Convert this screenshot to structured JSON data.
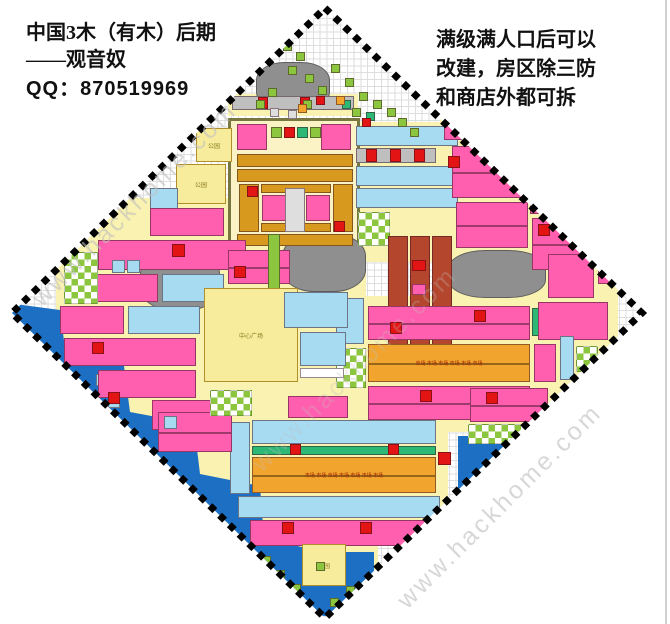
{
  "header": {
    "left": {
      "line1": "中国3木（有木）后期",
      "line2": "——观音奴",
      "line3": "QQ：870519969"
    },
    "right": {
      "line1": "满级满人口后可以",
      "line2": "改建，房区除三防",
      "line3": "和商店外都可拆"
    }
  },
  "watermark": {
    "text": "www.hackhome.com"
  },
  "map": {
    "labels": {
      "plaza": "中心广场",
      "park": "公园",
      "market": "市场"
    },
    "colors": {
      "road": "#FAF2B0",
      "cream": "#FBF3C6",
      "P": "#FF5FAE",
      "R": "#E21414",
      "C": "#A6DBF2",
      "B": "#1C6FC2",
      "G": "#8CC63F",
      "T": "#2EB876",
      "O": "#F2A52E",
      "D": "#D79A1E",
      "M": "#B5462E",
      "A": "#8F8F8F",
      "E": "#DEDEDE",
      "N": "#BFBFBF",
      "L": "#F7EC9C",
      "W": "#FFFFFF"
    },
    "rects": [
      {
        "x": 228,
        "y": 94,
        "w": 130,
        "h": 22,
        "c": "road"
      },
      {
        "x": 352,
        "y": 122,
        "w": 112,
        "h": 140,
        "c": "road"
      },
      {
        "x": 440,
        "y": 84,
        "w": 140,
        "h": 100,
        "c": "road"
      },
      {
        "x": 448,
        "y": 180,
        "w": 170,
        "h": 250,
        "c": "road"
      },
      {
        "x": 56,
        "y": 198,
        "w": 176,
        "h": 242,
        "c": "road"
      },
      {
        "x": 198,
        "y": 238,
        "w": 168,
        "h": 154,
        "c": "road"
      },
      {
        "x": 148,
        "y": 390,
        "w": 234,
        "h": 150,
        "c": "road"
      },
      {
        "x": 234,
        "y": 414,
        "w": 214,
        "h": 128,
        "c": "road"
      },
      {
        "x": 278,
        "y": 538,
        "w": 100,
        "h": 58,
        "c": "road"
      },
      {
        "x": 350,
        "y": 296,
        "w": 186,
        "h": 136,
        "c": "road"
      },
      {
        "x": 228,
        "y": 118,
        "w": 132,
        "h": 128,
        "c": "cream",
        "bd": "cream"
      },
      {
        "poly": "0,302 60,310 66,356 124,366 130,412 194,424 200,474 260,486 264,538 314,550 320,624 0,624",
        "c": "B",
        "g": "b"
      },
      {
        "x": 458,
        "y": 436,
        "w": 90,
        "h": 86,
        "c": "B",
        "g": "b"
      },
      {
        "x": 298,
        "y": 552,
        "w": 76,
        "h": 64,
        "c": "B",
        "g": "b"
      },
      {
        "x": 222,
        "y": 540,
        "w": 66,
        "h": 58,
        "c": "B",
        "g": "b"
      },
      {
        "x": 84,
        "y": 350,
        "w": 12,
        "h": 12,
        "c": "C"
      },
      {
        "x": 96,
        "y": 374,
        "w": 12,
        "h": 12,
        "c": "C"
      },
      {
        "x": 108,
        "y": 396,
        "w": 12,
        "h": 12,
        "c": "C"
      },
      {
        "x": 256,
        "y": 62,
        "w": 74,
        "h": 48,
        "c": "A",
        "g": "a",
        "r": 38
      },
      {
        "x": 140,
        "y": 252,
        "w": 80,
        "h": 58,
        "c": "A",
        "g": "a",
        "r": 38
      },
      {
        "x": 282,
        "y": 234,
        "w": 84,
        "h": 58,
        "c": "A",
        "g": "a",
        "r": 38
      },
      {
        "x": 448,
        "y": 250,
        "w": 98,
        "h": 48,
        "c": "A",
        "g": "a",
        "r": 38
      },
      {
        "x": 237,
        "y": 124,
        "w": 30,
        "h": 26,
        "c": "P"
      },
      {
        "x": 321,
        "y": 124,
        "w": 30,
        "h": 26,
        "c": "P"
      },
      {
        "x": 271,
        "y": 127,
        "w": 11,
        "h": 11,
        "c": "G"
      },
      {
        "x": 284,
        "y": 127,
        "w": 11,
        "h": 11,
        "c": "R"
      },
      {
        "x": 297,
        "y": 127,
        "w": 11,
        "h": 11,
        "c": "T"
      },
      {
        "x": 310,
        "y": 127,
        "w": 11,
        "h": 11,
        "c": "G"
      },
      {
        "x": 237,
        "y": 154,
        "w": 116,
        "h": 13,
        "c": "D",
        "u": 11
      },
      {
        "x": 237,
        "y": 169,
        "w": 116,
        "h": 13,
        "c": "D",
        "u": 11
      },
      {
        "x": 239,
        "y": 184,
        "w": 20,
        "h": 48,
        "c": "D"
      },
      {
        "x": 333,
        "y": 184,
        "w": 20,
        "h": 48,
        "c": "D"
      },
      {
        "x": 261,
        "y": 184,
        "w": 70,
        "h": 9,
        "c": "D"
      },
      {
        "x": 261,
        "y": 223,
        "w": 70,
        "h": 9,
        "c": "D"
      },
      {
        "x": 262,
        "y": 195,
        "w": 24,
        "h": 26,
        "c": "P"
      },
      {
        "x": 306,
        "y": 195,
        "w": 24,
        "h": 26,
        "c": "P"
      },
      {
        "x": 285,
        "y": 188,
        "w": 20,
        "h": 44,
        "c": "E"
      },
      {
        "x": 247,
        "y": 186,
        "w": 11,
        "h": 11,
        "c": "R"
      },
      {
        "x": 334,
        "y": 221,
        "w": 11,
        "h": 11,
        "c": "R"
      },
      {
        "x": 237,
        "y": 234,
        "w": 116,
        "h": 12,
        "c": "D",
        "u": 11
      },
      {
        "x": 232,
        "y": 96,
        "w": 122,
        "h": 14,
        "c": "N",
        "u": 11
      },
      {
        "x": 258,
        "y": 97,
        "w": 10,
        "h": 12,
        "c": "R"
      },
      {
        "x": 300,
        "y": 97,
        "w": 10,
        "h": 12,
        "c": "R"
      },
      {
        "x": 356,
        "y": 126,
        "w": 102,
        "h": 20,
        "c": "C",
        "u": 22
      },
      {
        "x": 356,
        "y": 148,
        "w": 80,
        "h": 15,
        "c": "N",
        "u": 11
      },
      {
        "x": 366,
        "y": 149,
        "w": 11,
        "h": 13,
        "c": "R"
      },
      {
        "x": 390,
        "y": 149,
        "w": 11,
        "h": 13,
        "c": "R"
      },
      {
        "x": 414,
        "y": 149,
        "w": 11,
        "h": 13,
        "c": "R"
      },
      {
        "x": 356,
        "y": 166,
        "w": 102,
        "h": 20,
        "c": "C",
        "u": 22
      },
      {
        "x": 356,
        "y": 188,
        "w": 102,
        "h": 20,
        "c": "C",
        "u": 22
      },
      {
        "x": 358,
        "y": 212,
        "w": 32,
        "h": 34,
        "c": "S"
      },
      {
        "x": 388,
        "y": 236,
        "w": 20,
        "h": 112,
        "c": "M"
      },
      {
        "x": 410,
        "y": 236,
        "w": 20,
        "h": 112,
        "c": "M"
      },
      {
        "x": 432,
        "y": 236,
        "w": 20,
        "h": 112,
        "c": "M"
      },
      {
        "x": 412,
        "y": 260,
        "w": 14,
        "h": 11,
        "c": "R"
      },
      {
        "x": 412,
        "y": 284,
        "w": 14,
        "h": 11,
        "c": "P"
      },
      {
        "x": 412,
        "y": 308,
        "w": 14,
        "h": 11,
        "c": "R"
      },
      {
        "x": 336,
        "y": 298,
        "w": 28,
        "h": 46,
        "c": "C"
      },
      {
        "x": 336,
        "y": 348,
        "w": 30,
        "h": 40,
        "c": "S"
      },
      {
        "x": 368,
        "y": 306,
        "w": 162,
        "h": 34,
        "c": "P",
        "u": 22,
        "m": 1
      },
      {
        "x": 390,
        "y": 322,
        "w": 12,
        "h": 12,
        "c": "R"
      },
      {
        "x": 474,
        "y": 310,
        "w": 12,
        "h": 12,
        "c": "R"
      },
      {
        "x": 368,
        "y": 344,
        "w": 162,
        "h": 38,
        "c": "O",
        "u": 22,
        "m": 1,
        "l": "market"
      },
      {
        "x": 368,
        "y": 386,
        "w": 162,
        "h": 34,
        "c": "P",
        "u": 22,
        "m": 1
      },
      {
        "x": 420,
        "y": 390,
        "w": 12,
        "h": 12,
        "c": "R"
      },
      {
        "x": 532,
        "y": 308,
        "w": 14,
        "h": 28,
        "c": "T"
      },
      {
        "x": 444,
        "y": 90,
        "w": 56,
        "h": 50,
        "c": "P",
        "m": 1
      },
      {
        "x": 504,
        "y": 118,
        "w": 42,
        "h": 38,
        "c": "P"
      },
      {
        "x": 452,
        "y": 146,
        "w": 74,
        "h": 52,
        "c": "P",
        "u": 22,
        "m": 1
      },
      {
        "x": 530,
        "y": 170,
        "w": 54,
        "h": 44,
        "c": "P",
        "m": 1
      },
      {
        "x": 456,
        "y": 202,
        "w": 72,
        "h": 46,
        "c": "P",
        "u": 22,
        "m": 1
      },
      {
        "x": 532,
        "y": 218,
        "w": 62,
        "h": 52,
        "c": "P",
        "m": 1
      },
      {
        "x": 448,
        "y": 156,
        "w": 12,
        "h": 12,
        "c": "R"
      },
      {
        "x": 538,
        "y": 224,
        "w": 12,
        "h": 12,
        "c": "R"
      },
      {
        "x": 548,
        "y": 254,
        "w": 46,
        "h": 44,
        "c": "P"
      },
      {
        "x": 598,
        "y": 258,
        "w": 26,
        "h": 26,
        "c": "P"
      },
      {
        "x": 538,
        "y": 302,
        "w": 70,
        "h": 38,
        "c": "P",
        "u": 22
      },
      {
        "x": 560,
        "y": 336,
        "w": 14,
        "h": 44,
        "c": "C"
      },
      {
        "x": 576,
        "y": 346,
        "w": 22,
        "h": 26,
        "c": "S"
      },
      {
        "x": 580,
        "y": 374,
        "w": 34,
        "h": 24,
        "c": "P"
      },
      {
        "x": 534,
        "y": 344,
        "w": 22,
        "h": 38,
        "c": "P"
      },
      {
        "x": 470,
        "y": 388,
        "w": 78,
        "h": 34,
        "c": "P",
        "u": 22,
        "m": 1
      },
      {
        "x": 486,
        "y": 392,
        "w": 12,
        "h": 12,
        "c": "R"
      },
      {
        "x": 468,
        "y": 424,
        "w": 78,
        "h": 20,
        "c": "S"
      },
      {
        "x": 196,
        "y": 128,
        "w": 36,
        "h": 34,
        "c": "L",
        "l": "park"
      },
      {
        "x": 176,
        "y": 164,
        "w": 50,
        "h": 40,
        "c": "L",
        "l": "park"
      },
      {
        "x": 150,
        "y": 188,
        "w": 28,
        "h": 24,
        "c": "C"
      },
      {
        "x": 150,
        "y": 208,
        "w": 74,
        "h": 28,
        "c": "P",
        "u": 22
      },
      {
        "x": 98,
        "y": 240,
        "w": 148,
        "h": 30,
        "c": "P",
        "u": 22
      },
      {
        "x": 172,
        "y": 244,
        "w": 13,
        "h": 13,
        "c": "R"
      },
      {
        "x": 66,
        "y": 274,
        "w": 92,
        "h": 28,
        "c": "P",
        "u": 22
      },
      {
        "x": 162,
        "y": 274,
        "w": 62,
        "h": 28,
        "c": "C",
        "u": 22
      },
      {
        "x": 60,
        "y": 306,
        "w": 64,
        "h": 28,
        "c": "P",
        "u": 22
      },
      {
        "x": 128,
        "y": 306,
        "w": 72,
        "h": 28,
        "c": "C",
        "u": 22
      },
      {
        "x": 64,
        "y": 338,
        "w": 132,
        "h": 28,
        "c": "P",
        "u": 22
      },
      {
        "x": 92,
        "y": 342,
        "w": 12,
        "h": 12,
        "c": "R"
      },
      {
        "x": 98,
        "y": 370,
        "w": 98,
        "h": 28,
        "c": "P",
        "u": 22
      },
      {
        "x": 108,
        "y": 392,
        "w": 12,
        "h": 12,
        "c": "R"
      },
      {
        "x": 152,
        "y": 400,
        "w": 72,
        "h": 30,
        "c": "P",
        "u": 22
      },
      {
        "x": 64,
        "y": 252,
        "w": 34,
        "h": 52,
        "c": "S"
      },
      {
        "x": 112,
        "y": 260,
        "w": 13,
        "h": 13,
        "c": "C"
      },
      {
        "x": 127,
        "y": 260,
        "w": 13,
        "h": 13,
        "c": "C"
      },
      {
        "x": 228,
        "y": 250,
        "w": 62,
        "h": 34,
        "c": "P",
        "u": 22,
        "m": 1
      },
      {
        "x": 234,
        "y": 266,
        "w": 12,
        "h": 12,
        "c": "R"
      },
      {
        "x": 268,
        "y": 234,
        "w": 12,
        "h": 60,
        "c": "G"
      },
      {
        "x": 204,
        "y": 288,
        "w": 94,
        "h": 94,
        "c": "L",
        "l": "plaza"
      },
      {
        "x": 284,
        "y": 292,
        "w": 64,
        "h": 36,
        "c": "C",
        "u": 22
      },
      {
        "x": 300,
        "y": 332,
        "w": 46,
        "h": 34,
        "c": "C",
        "u": 22
      },
      {
        "x": 300,
        "y": 368,
        "w": 44,
        "h": 10,
        "c": "W",
        "u": 11
      },
      {
        "x": 230,
        "y": 422,
        "w": 20,
        "h": 72,
        "c": "C"
      },
      {
        "x": 288,
        "y": 396,
        "w": 60,
        "h": 22,
        "c": "P",
        "u": 22
      },
      {
        "x": 252,
        "y": 420,
        "w": 184,
        "h": 24,
        "c": "C",
        "u": 22
      },
      {
        "x": 252,
        "y": 446,
        "w": 184,
        "h": 9,
        "c": "T",
        "u": 11
      },
      {
        "x": 252,
        "y": 457,
        "w": 184,
        "h": 36,
        "c": "O",
        "u": 22,
        "m": 1,
        "l": "market"
      },
      {
        "x": 290,
        "y": 444,
        "w": 11,
        "h": 11,
        "c": "R"
      },
      {
        "x": 388,
        "y": 444,
        "w": 11,
        "h": 11,
        "c": "R"
      },
      {
        "x": 438,
        "y": 452,
        "w": 13,
        "h": 13,
        "c": "R"
      },
      {
        "x": 238,
        "y": 496,
        "w": 202,
        "h": 22,
        "c": "C",
        "u": 22
      },
      {
        "x": 250,
        "y": 520,
        "w": 180,
        "h": 26,
        "c": "P",
        "u": 22
      },
      {
        "x": 282,
        "y": 522,
        "w": 12,
        "h": 12,
        "c": "R"
      },
      {
        "x": 360,
        "y": 522,
        "w": 12,
        "h": 12,
        "c": "R"
      },
      {
        "x": 158,
        "y": 412,
        "w": 74,
        "h": 40,
        "c": "P",
        "u": 22,
        "m": 1
      },
      {
        "x": 164,
        "y": 416,
        "w": 13,
        "h": 13,
        "c": "C"
      },
      {
        "x": 302,
        "y": 544,
        "w": 44,
        "h": 42,
        "c": "L",
        "l": "park"
      },
      {
        "x": 210,
        "y": 390,
        "w": 42,
        "h": 26,
        "c": "S"
      }
    ],
    "scatter": [
      [
        283,
        42,
        "G"
      ],
      [
        296,
        52,
        "G"
      ],
      [
        288,
        66,
        "G"
      ],
      [
        305,
        74,
        "G"
      ],
      [
        318,
        86,
        "G"
      ],
      [
        331,
        64,
        "G"
      ],
      [
        345,
        78,
        "G"
      ],
      [
        359,
        92,
        "G"
      ],
      [
        373,
        100,
        "G"
      ],
      [
        387,
        108,
        "G"
      ],
      [
        303,
        100,
        "G"
      ],
      [
        268,
        88,
        "G"
      ],
      [
        256,
        100,
        "G"
      ],
      [
        398,
        118,
        "G"
      ],
      [
        352,
        108,
        "G"
      ],
      [
        410,
        128,
        "G"
      ],
      [
        342,
        100,
        "T"
      ],
      [
        366,
        112,
        "T"
      ],
      [
        316,
        96,
        "R"
      ],
      [
        362,
        118,
        "R"
      ],
      [
        298,
        104,
        "O"
      ],
      [
        336,
        96,
        "O"
      ],
      [
        270,
        108,
        "E"
      ],
      [
        288,
        110,
        "E"
      ],
      [
        262,
        556,
        "G"
      ],
      [
        276,
        570,
        "G"
      ],
      [
        292,
        584,
        "G"
      ],
      [
        330,
        598,
        "G"
      ],
      [
        316,
        562,
        "G"
      ],
      [
        346,
        586,
        "G"
      ]
    ]
  }
}
